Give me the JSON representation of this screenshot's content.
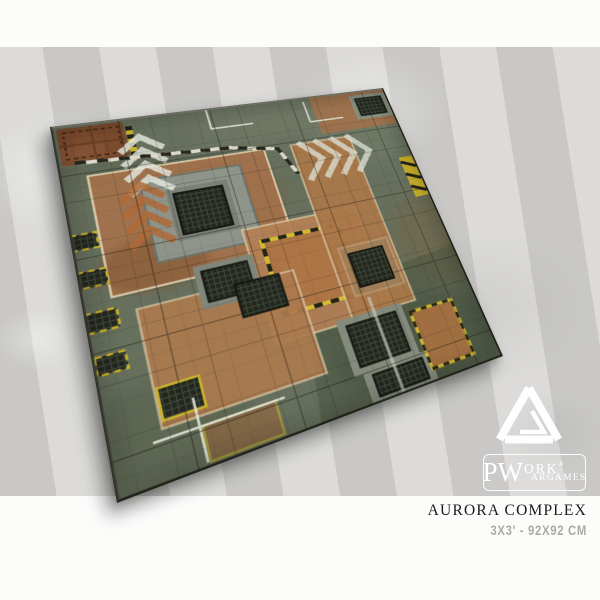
{
  "product": {
    "title": "AURORA COMPLEX",
    "size": "3x3' - 92x92 cm"
  },
  "brand": {
    "monogram": "PW",
    "word_top": "ORK",
    "registered": "®",
    "word_bottom": "ARGAMES",
    "logo_icon": "pwork-triangle-logo",
    "color": "#ffffff"
  },
  "mat": {
    "alt": "Aurora Complex wargaming mat - top-down industrial complex with square grid, concrete and rust platforms, metal grates, hazard stripe markings",
    "palette": {
      "base_green": "#67705d",
      "concrete_gray": "#8e948a",
      "rust_orange": "#aa7748",
      "tan_center": "#b28055",
      "hazard_yellow": "#c9b02a",
      "grate_dark": "#23271e",
      "marking_white": "#e8ebe2",
      "leather_patch": "#7b4b2d"
    },
    "features": [
      "square-grid",
      "concrete-platform",
      "rust-platforms",
      "metal-grates",
      "hazard-stripe-borders",
      "white-chevrons",
      "rust-chevrons",
      "yellow-zone-outlines",
      "leather-patch",
      "pipe-lines"
    ]
  },
  "background": {
    "stripe_dark": "#c9c8c6",
    "stripe_light": "#dcdbd9",
    "band_color": "#fcfcfb"
  }
}
